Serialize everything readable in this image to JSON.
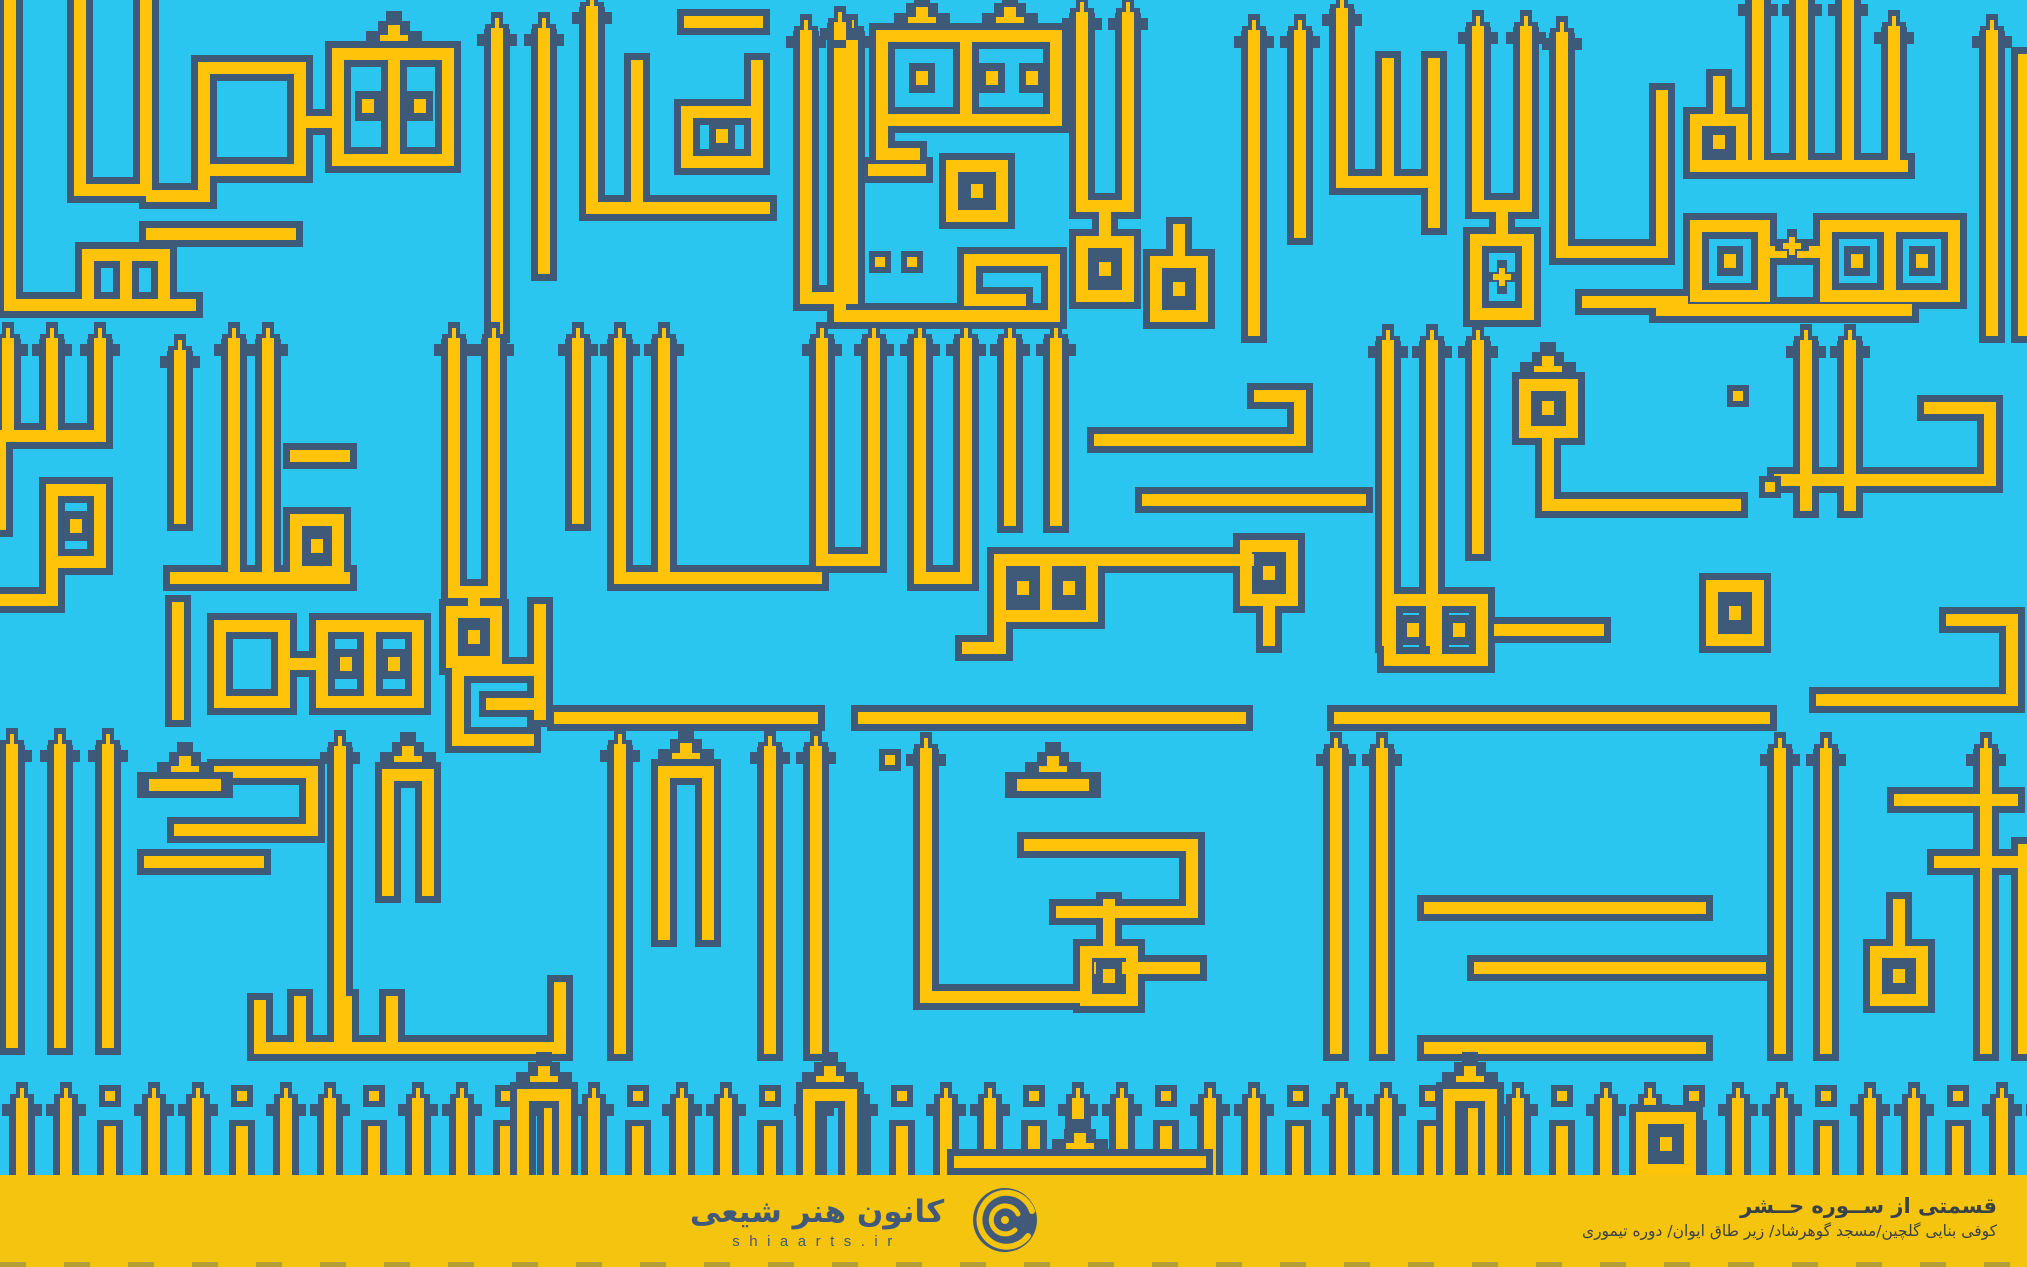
{
  "colors": {
    "cyan": "#2bc6f0",
    "navy": "#3e5a78",
    "yellow": "#ffc40a",
    "footer_yellow": "#f5c40e",
    "footer_text": "#3a4149",
    "logo_navy": "#41597a"
  },
  "footer": {
    "wordmark": "کانون هنر شیعی",
    "domain": "shiaarts.ir",
    "credit_title": "قسمتی از ســوره حــشر",
    "credit_subtitle": "کوفی بنایی گلچین/مسجد گوهرشاد/ زیر طاق ایوان/ دوره تیموری"
  }
}
